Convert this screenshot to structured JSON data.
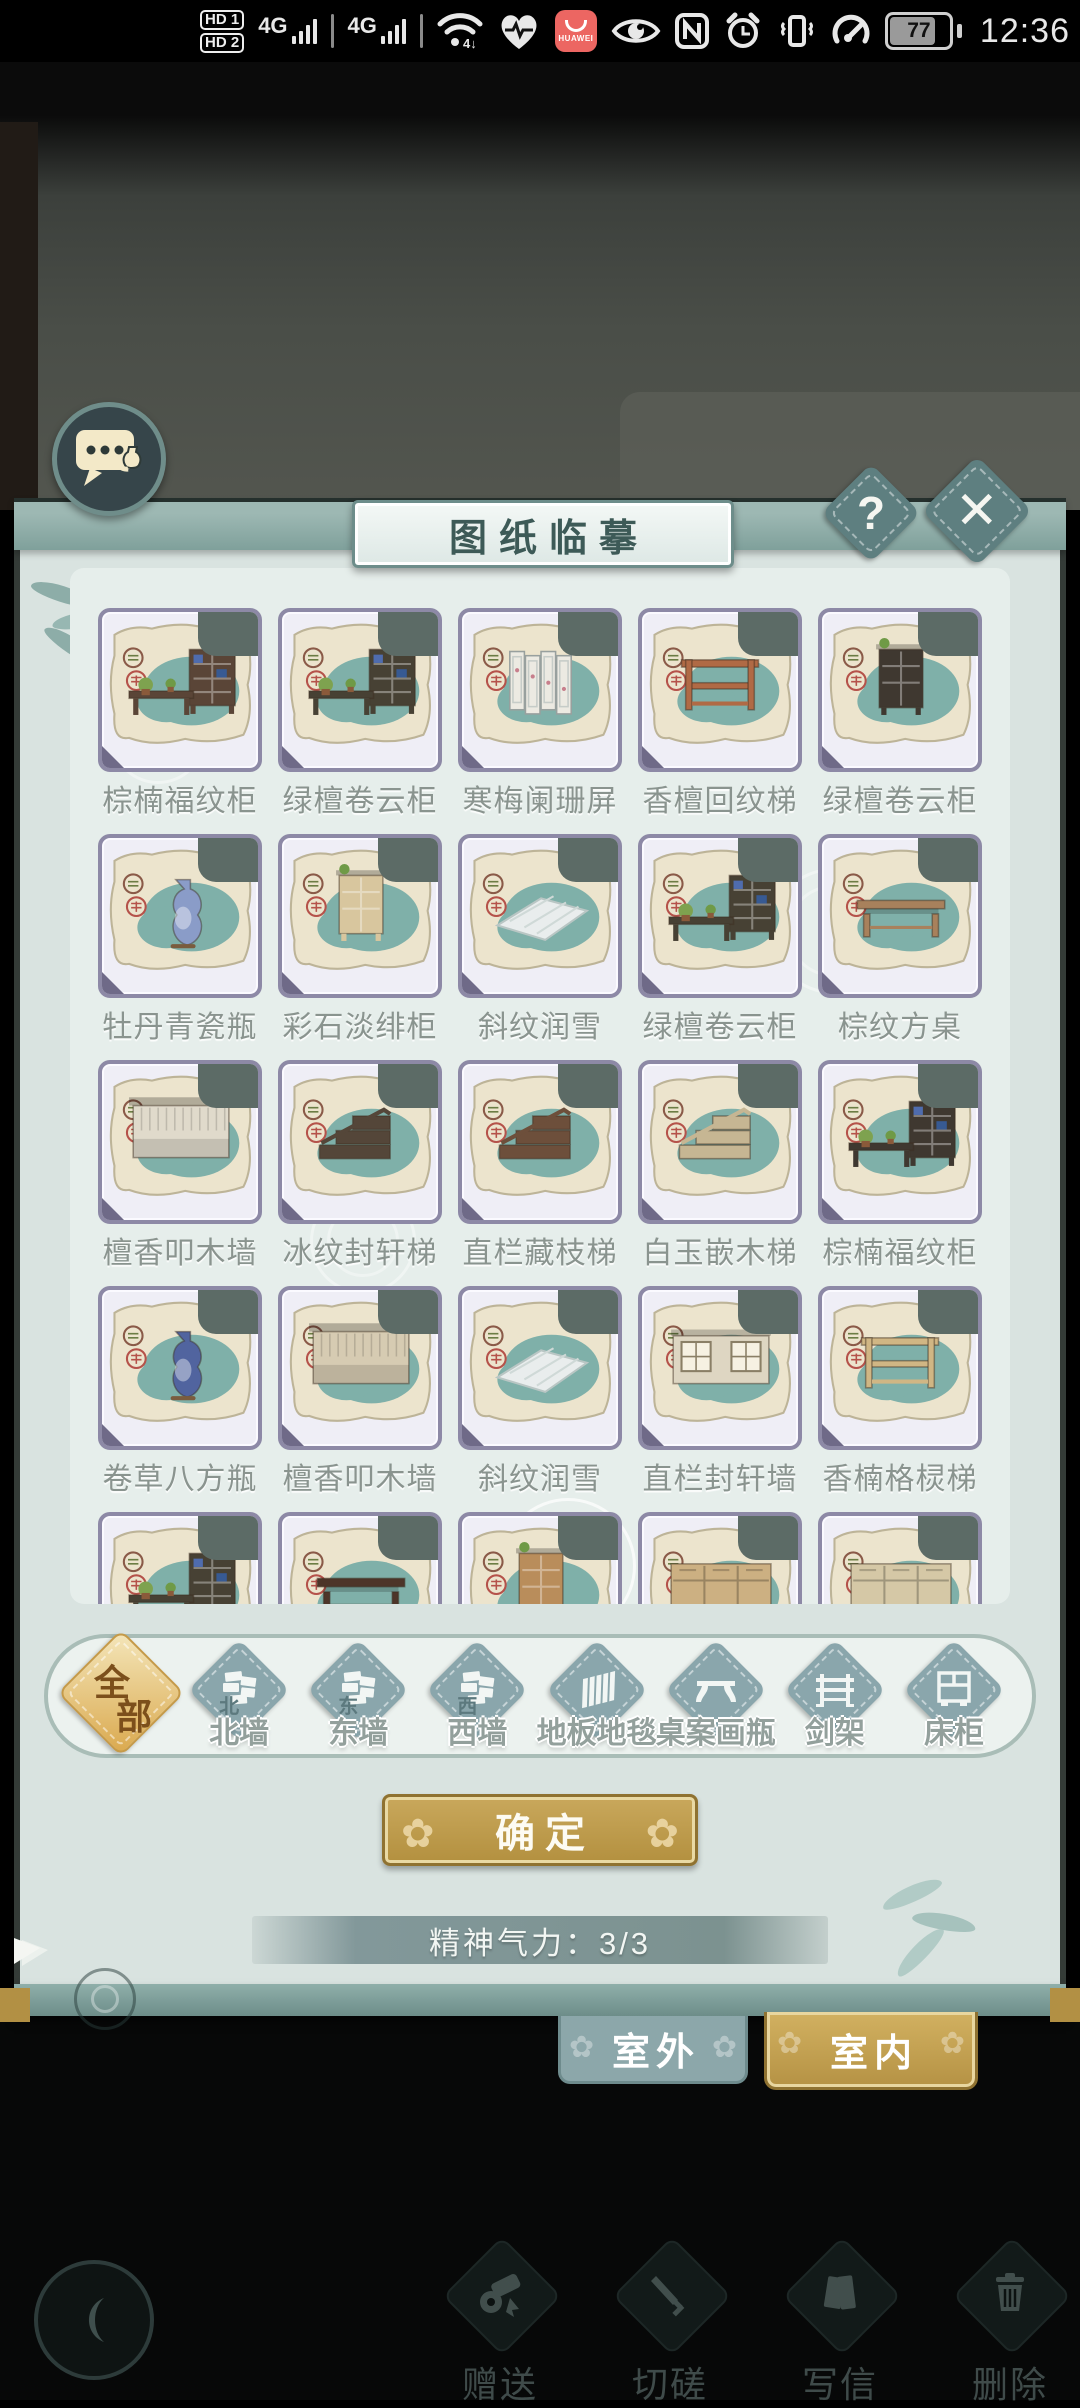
{
  "status_bar": {
    "time": "12:36",
    "battery_percent": "77",
    "sim1_label": "HD 1",
    "sim2_label": "HD 2",
    "network1_label": "4G",
    "network2_label": "4G",
    "huawei_label": "HUAWEI"
  },
  "dialog": {
    "title": "图纸临摹",
    "help_label": "?",
    "close_label": "✕",
    "confirm_label": "确定",
    "stamina_label": "精神气力：3/3",
    "items": [
      {
        "name": "棕楠福纹柜",
        "type": "cabinet-desk",
        "color": "#5a4537"
      },
      {
        "name": "绿檀卷云柜",
        "type": "cabinet-desk",
        "color": "#474134"
      },
      {
        "name": "寒梅阑珊屏",
        "type": "screen",
        "color": "#eceae2"
      },
      {
        "name": "香檀回纹梯",
        "type": "desk",
        "color": "#b06a45"
      },
      {
        "name": "绿檀卷云柜",
        "type": "cabinet",
        "color": "#3f3830"
      },
      {
        "name": "牡丹青瓷瓶",
        "type": "vase",
        "color": "#8a9cc8"
      },
      {
        "name": "彩石淡绯柜",
        "type": "cabinet",
        "color": "#d8c69e"
      },
      {
        "name": "斜纹润雪",
        "type": "floor",
        "color": "#e9eded"
      },
      {
        "name": "绿檀卷云柜",
        "type": "cabinet-desk",
        "color": "#474134"
      },
      {
        "name": "棕纹方桌",
        "type": "table",
        "color": "#a8815c"
      },
      {
        "name": "檀香叩木墙",
        "type": "wall",
        "color": "#e0dacb"
      },
      {
        "name": "冰纹封轩梯",
        "type": "stairs",
        "color": "#544639"
      },
      {
        "name": "直栏藏枝梯",
        "type": "stairs",
        "color": "#6d4f3b"
      },
      {
        "name": "白玉嵌木梯",
        "type": "stairs",
        "color": "#c6b693"
      },
      {
        "name": "棕楠福纹柜",
        "type": "cabinet-desk",
        "color": "#3f3830"
      },
      {
        "name": "卷草八方瓶",
        "type": "vase",
        "color": "#51649f"
      },
      {
        "name": "檀香叩木墙",
        "type": "wall",
        "color": "#d6cbb2"
      },
      {
        "name": "斜纹润雪",
        "type": "floor",
        "color": "#e9eded"
      },
      {
        "name": "直栏封轩墙",
        "type": "window-wall",
        "color": "#ded6c2"
      },
      {
        "name": "香楠格棂梯",
        "type": "desk",
        "color": "#d0b684"
      },
      {
        "name": "",
        "type": "cabinet-desk",
        "color": "#474134"
      },
      {
        "name": "",
        "type": "table",
        "color": "#4d3529"
      },
      {
        "name": "",
        "type": "cabinet",
        "color": "#b98d5b"
      },
      {
        "name": "",
        "type": "sideboard",
        "color": "#ccb082"
      },
      {
        "name": "",
        "type": "sideboard",
        "color": "#d5c8a6"
      }
    ],
    "categories": [
      {
        "label": "全部",
        "kind": "all",
        "selected": true
      },
      {
        "label": "北墙",
        "kind": "wall",
        "char": "北",
        "selected": false
      },
      {
        "label": "东墙",
        "kind": "wall",
        "char": "东",
        "selected": false
      },
      {
        "label": "西墙",
        "kind": "wall",
        "char": "西",
        "selected": false
      },
      {
        "label": "地板地毯",
        "kind": "floor",
        "selected": false
      },
      {
        "label": "桌案画瓶",
        "kind": "table",
        "selected": false
      },
      {
        "label": "剑架",
        "kind": "rack",
        "selected": false
      },
      {
        "label": "床柜",
        "kind": "bedcab",
        "selected": false
      }
    ]
  },
  "scene_tabs": {
    "outdoor_label": "室外",
    "indoor_label": "室内"
  },
  "action_bar": {
    "actions": [
      {
        "label": "赠送",
        "icon": "gift-scroll"
      },
      {
        "label": "切磋",
        "icon": "sword"
      },
      {
        "label": "写信",
        "icon": "letter"
      },
      {
        "label": "删除",
        "icon": "trash"
      }
    ]
  },
  "colors": {
    "accent_gold": "#b9974c",
    "panel": "#d9e3e0",
    "teal_trim": "#7fa09b",
    "card_border": "#8d89a6",
    "blob_teal": "#7fb0a9",
    "paper": "#ece4cd"
  }
}
